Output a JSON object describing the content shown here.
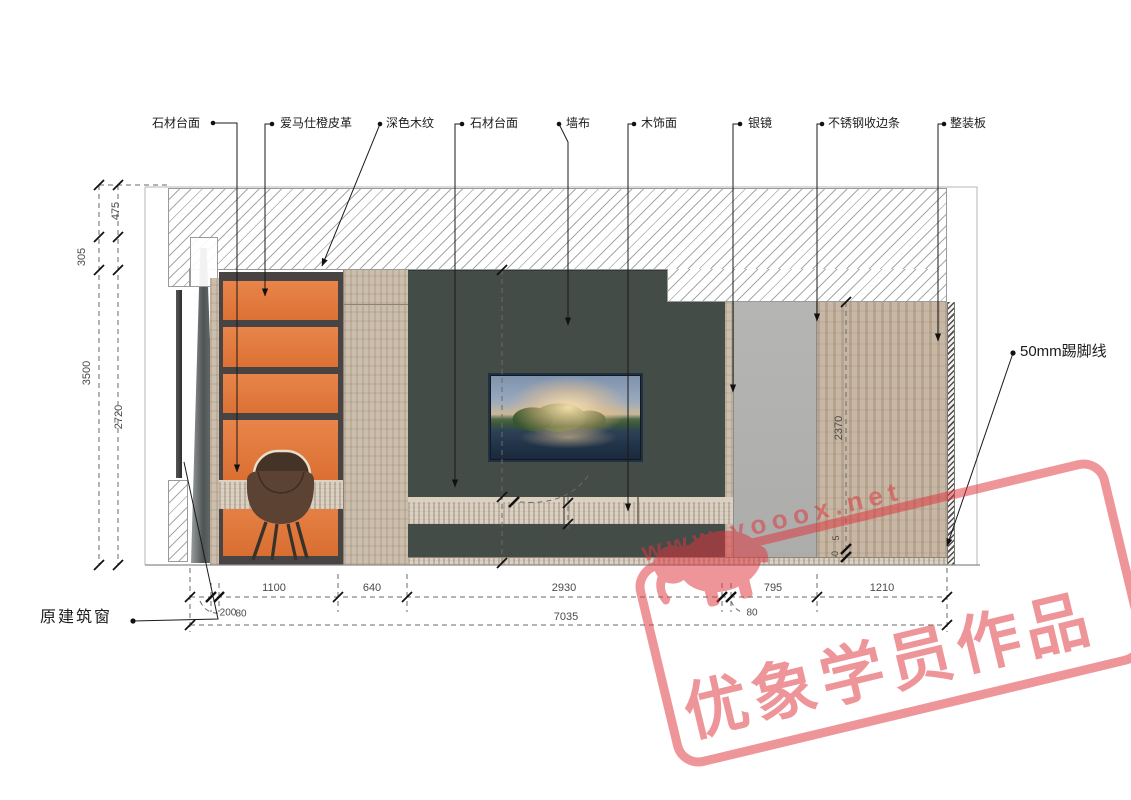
{
  "callouts": {
    "stone_top_1": "石材台面",
    "hermes_orange_leather": "爱马仕橙皮革",
    "dark_wood_grain": "深色木纹",
    "stone_top_2": "石材台面",
    "wall_fabric": "墙布",
    "wood_veneer": "木饰面",
    "silver_mirror": "银镜",
    "stainless_steel_trim": "不锈钢收边条",
    "prefab_panel": "整装板",
    "skirting_label": "50mm踢脚线",
    "original_window": "原建筑窗"
  },
  "dims": {
    "d3500": "3500",
    "d305": "305",
    "d475": "475",
    "d2720": "2720",
    "d2120": "2120",
    "d600": "600",
    "d195": "195",
    "d55": "55",
    "d2370": "2370",
    "d5": "5",
    "d50": "50",
    "d200": "200",
    "d80l": "80",
    "d1100": "1100",
    "d640": "640",
    "d2930": "2930",
    "d80r": "80",
    "d795": "795",
    "d1210": "1210",
    "d7035": "7035"
  },
  "watermark": {
    "url": "www.yooox.net",
    "text": "优象学员作品",
    "color": "#e0353f"
  },
  "colors": {
    "orange_leather": "#e1773a",
    "dark_frame": "#474443",
    "wall_fabric_green": "#434c46",
    "mirror_gray": "#b1b1af",
    "wood_light": "#cbbead",
    "stone": "#cdc0af"
  }
}
